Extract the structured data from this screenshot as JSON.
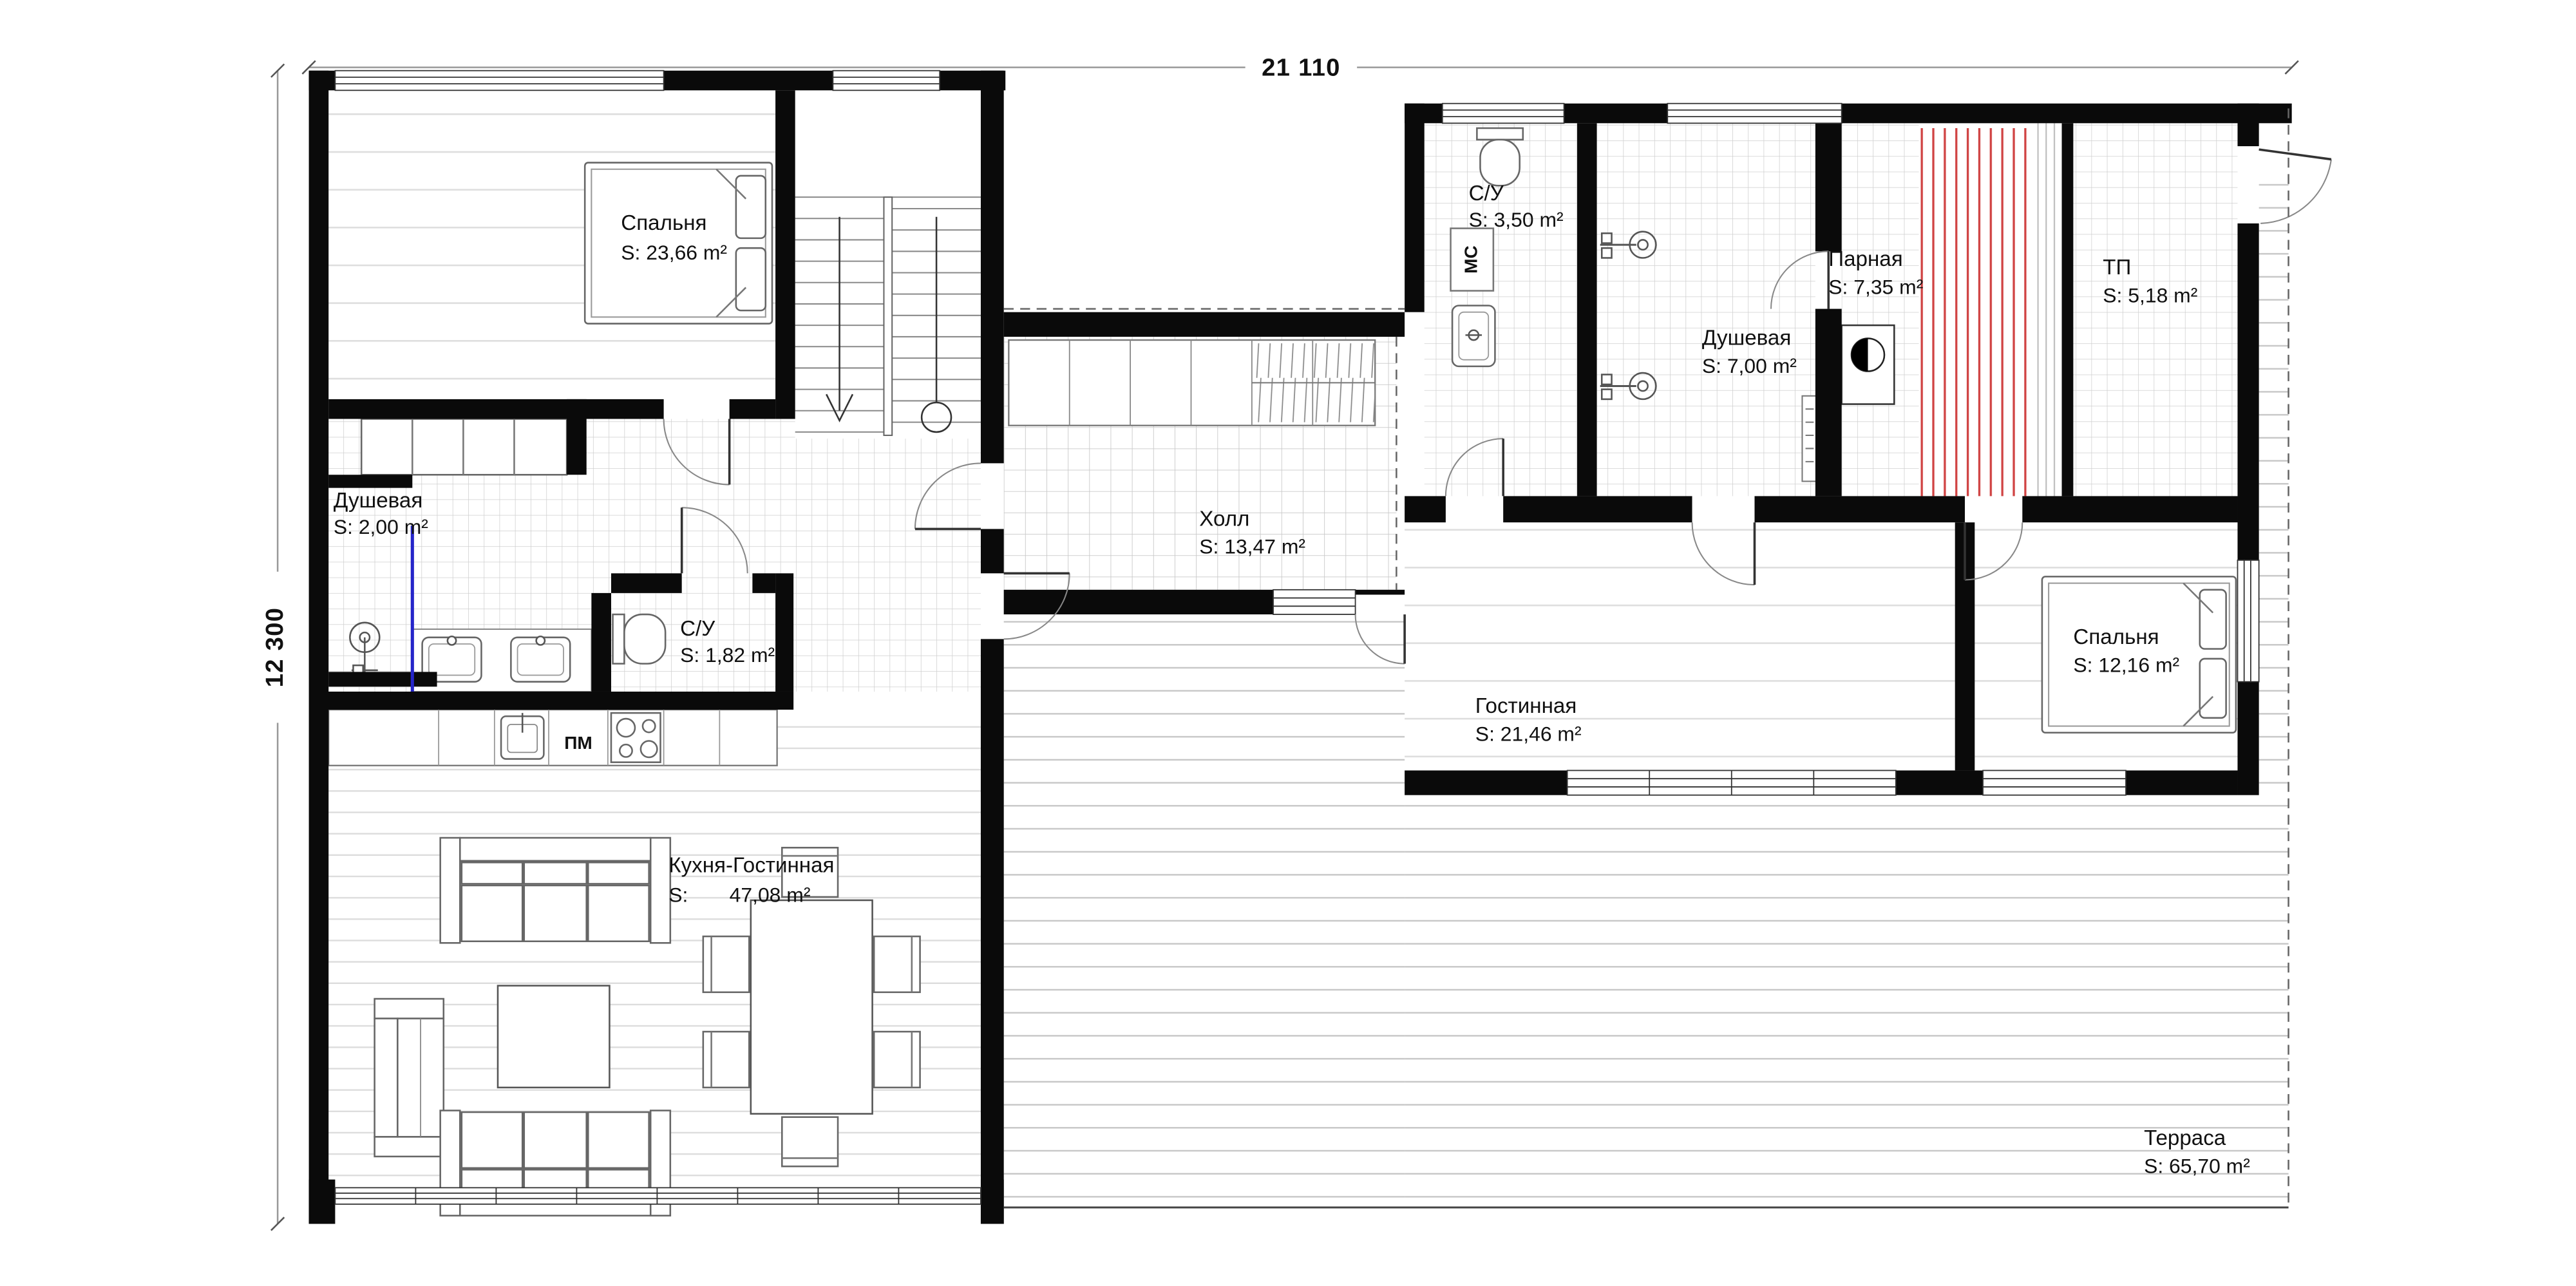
{
  "dimensions": {
    "width_label": "21 110",
    "height_label": "12 300"
  },
  "rooms": [
    {
      "id": "bedroom-1",
      "name": "Спальня",
      "area": "S: 23,66 m²"
    },
    {
      "id": "shower-1",
      "name": "Душевая",
      "area": "S: 2,00 m²"
    },
    {
      "id": "wc-1",
      "name": "С/У",
      "area": "S: 1,82 m²"
    },
    {
      "id": "kitchen-living",
      "name": "Кухня-Гостинная",
      "area_prefix": "S:",
      "area_value": "47,08 m²"
    },
    {
      "id": "hall",
      "name": "Холл",
      "area": "S: 13,47 m²"
    },
    {
      "id": "wc-2",
      "name": "С/У",
      "area": "S: 3,50 m²"
    },
    {
      "id": "steam-room",
      "name": "Парная",
      "area": "S: 7,35 m²"
    },
    {
      "id": "shower-2",
      "name": "Душевая",
      "area": "S: 7,00 m²"
    },
    {
      "id": "heated-floor",
      "name": "ТП",
      "area": "S: 5,18 m²"
    },
    {
      "id": "living-room",
      "name": "Гостинная",
      "area": "S: 21,46 m²"
    },
    {
      "id": "bedroom-2",
      "name": "Спальня",
      "area": "S: 12,16 m²"
    },
    {
      "id": "terrace",
      "name": "Терраса",
      "area": "S: 65,70 m²"
    }
  ],
  "appliances": {
    "dishwasher_label": "ПМ",
    "washing_machine_label": "МС"
  },
  "colors": {
    "wall": "#0a0a0a",
    "sauna_stripes": "#d04343",
    "shower_glass": "#2525c9",
    "tile_line": "#c9c9c9",
    "plank_line": "#d8d8d8",
    "dimension_line": "#9a9a9a",
    "text": "#111111"
  }
}
